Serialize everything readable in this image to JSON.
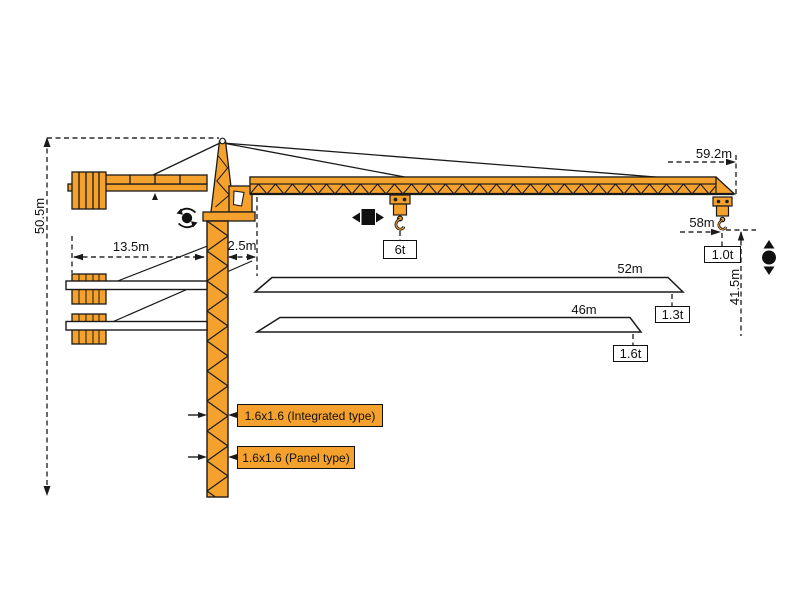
{
  "diagram": {
    "dimensions": {
      "total_height": "50.5m",
      "tail_radius": "13.5m",
      "jib_root_offset": "2.5m",
      "max_jib_radius": "59.2m",
      "max_hook_radius": "58m",
      "hook_height_at_tip": "41.5m"
    },
    "loads": {
      "max_load": "6t",
      "tip_load_main_jib": "1.0t"
    },
    "jib_options": [
      {
        "length": "52m",
        "tip_load": "1.3t"
      },
      {
        "length": "46m",
        "tip_load": "1.6t"
      }
    ],
    "mast_sections": {
      "integrated": "1.6x1.6 (Integrated type)",
      "panel": "1.6x1.6 (Panel type)"
    },
    "icons": {
      "slewing": "rotation-icon",
      "trolleying": "trolley-travel-icon",
      "hoisting": "hoisting-icon"
    },
    "colors": {
      "crane_orange": "#F5A12D",
      "outline": "#1A1A1A",
      "background": "#FFFFFF"
    }
  }
}
